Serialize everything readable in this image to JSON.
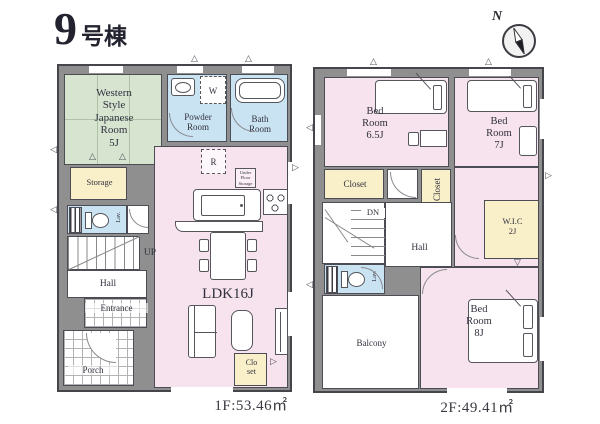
{
  "title": {
    "number": "9",
    "suffix": "号棟"
  },
  "compass": {
    "label": "N"
  },
  "floor1": {
    "caption": "1F:53.46㎡",
    "japanese_room": "Western\nStyle\nJapanese\nRoom\n5J",
    "powder_room": "Powder\nRoom",
    "bath_room": "Bath\nRoom",
    "storage": "Storage",
    "lavatory": "Lav.",
    "washer": "W",
    "fridge": "R",
    "under_floor_storage": "Under\nFloor\nStorage",
    "ldk": "LDK16J",
    "up": "UP",
    "hall": "Hall",
    "entrance": "Entrance",
    "porch": "Porch",
    "closet": "Clo\nset"
  },
  "floor2": {
    "caption": "2F:49.41㎡",
    "bedroom_65": "Bed\nRoom\n6.5J",
    "bedroom_7": "Bed\nRoom\n7J",
    "bedroom_8": "Bed\nRoom\n8J",
    "closet_a": "Closet",
    "closet_b": "Closet",
    "wic": "W.I.C\n2J",
    "down": "DN",
    "hall": "Hall",
    "lavatory": "Lav.",
    "balcony": "Balcony"
  }
}
